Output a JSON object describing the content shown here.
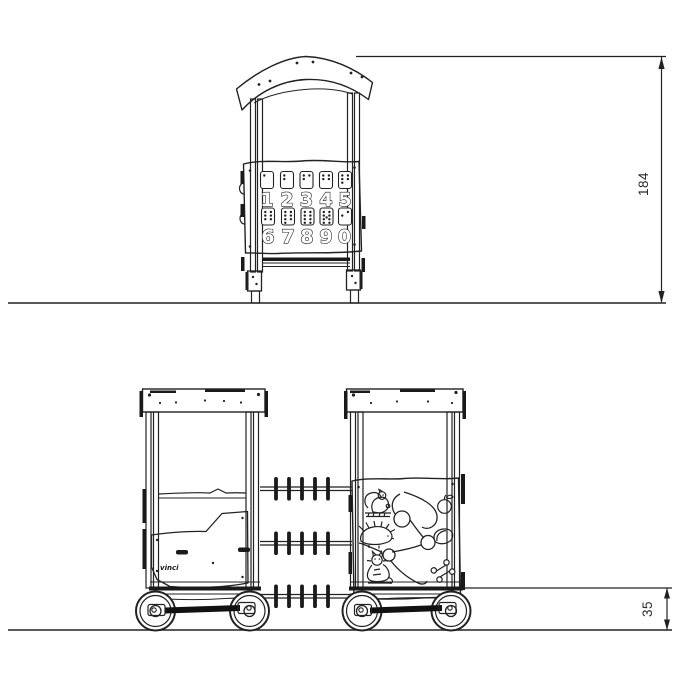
{
  "dimensions": {
    "overall_height_cm": "184",
    "platform_height_cm": "35"
  },
  "number_panel": {
    "row1": [
      "1",
      "2",
      "3",
      "4",
      "5"
    ],
    "row2": [
      "6",
      "7",
      "8",
      "9",
      "0"
    ]
  },
  "brand_logo": "vinci",
  "activity_panel_icons": [
    "squirrel",
    "apple",
    "hedgehog",
    "nut",
    "cat",
    "bone",
    "winding-path"
  ],
  "colors": {
    "line": "#222222",
    "background": "#ffffff",
    "fill_dark": "#1a1a1a"
  }
}
